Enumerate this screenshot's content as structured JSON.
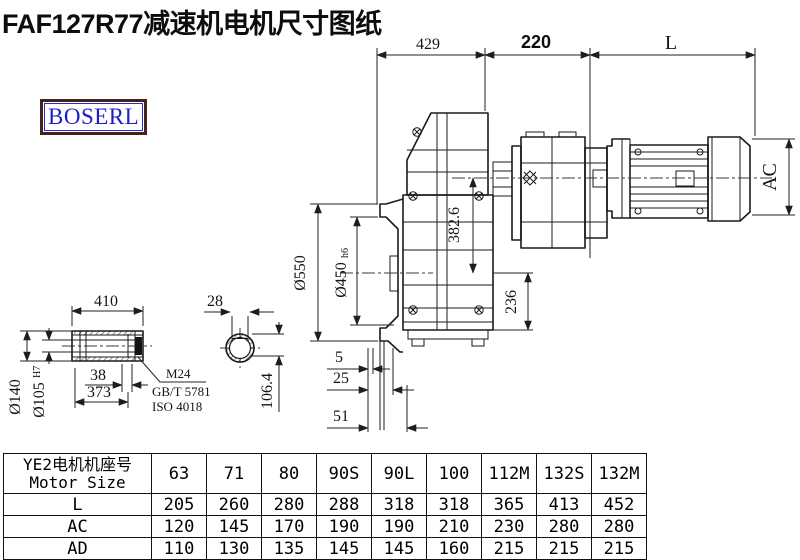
{
  "title": "FAF127R77减速机电机尺寸图纸",
  "logo": "BOSERL",
  "drawing": {
    "top": {
      "d429": "429",
      "d220": "220",
      "dL": "L"
    },
    "side": {
      "dAC": "AC",
      "d382": "382.6",
      "d236": "236",
      "d550": "Ø550",
      "d450": "Ø450",
      "d450s": "h6",
      "d5": "5",
      "d25": "25",
      "d51": "51"
    },
    "shaft": {
      "d410": "410",
      "d140": "Ø140",
      "d105": "Ø105",
      "d105s": "H7",
      "d38": "38",
      "d373": "373",
      "thread": "M24",
      "std1": "GB/T 5781",
      "std2": "ISO 4018"
    },
    "section": {
      "d28": "28",
      "d106": "106.4"
    }
  },
  "table": {
    "header_cn": "YE2电机机座号",
    "header_en": "Motor Size",
    "columns": [
      "63",
      "71",
      "80",
      "90S",
      "90L",
      "100",
      "112M",
      "132S",
      "132M"
    ],
    "rows": [
      {
        "label": "L",
        "values": [
          "205",
          "260",
          "280",
          "288",
          "318",
          "318",
          "365",
          "413",
          "452"
        ]
      },
      {
        "label": "AC",
        "values": [
          "120",
          "145",
          "170",
          "190",
          "190",
          "210",
          "230",
          "280",
          "280"
        ]
      },
      {
        "label": "AD",
        "values": [
          "110",
          "130",
          "135",
          "145",
          "145",
          "160",
          "215",
          "215",
          "215"
        ]
      }
    ]
  }
}
